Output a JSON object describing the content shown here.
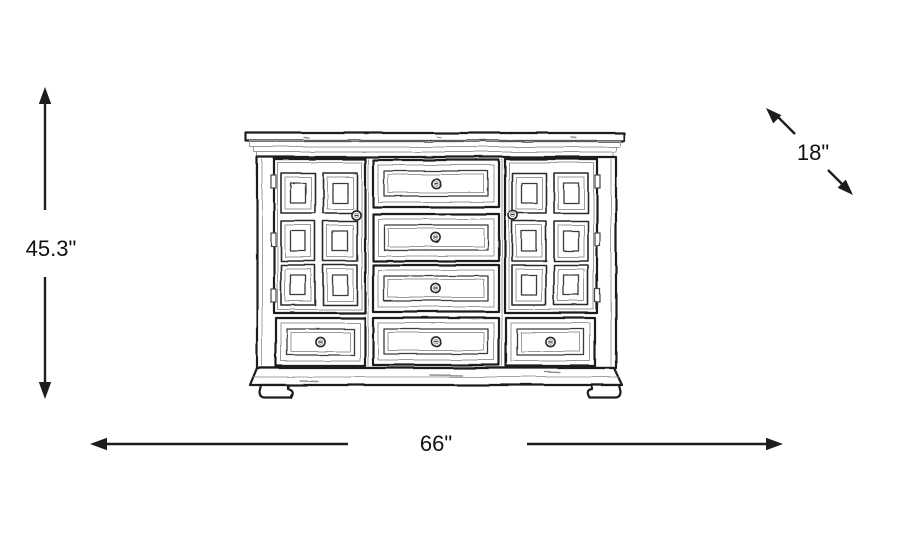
{
  "diagram": {
    "type": "furniture-dimension-diagram",
    "item": "paneled two-door dresser line sketch",
    "background_color": "#ffffff",
    "line_color": "#1d1d1d",
    "dimensions": {
      "height": {
        "value": "45.3\"",
        "axis": "vertical",
        "position": "left"
      },
      "width": {
        "value": "66\"",
        "axis": "horizontal",
        "position": "bottom"
      },
      "depth": {
        "value": "18\"",
        "axis": "diagonal",
        "position": "top-right"
      }
    },
    "furniture": {
      "doors": 2,
      "raised_panels_per_door": 6,
      "center_drawers": 3,
      "bottom_drawers": 3,
      "knobs": 8,
      "feet": 2
    }
  }
}
